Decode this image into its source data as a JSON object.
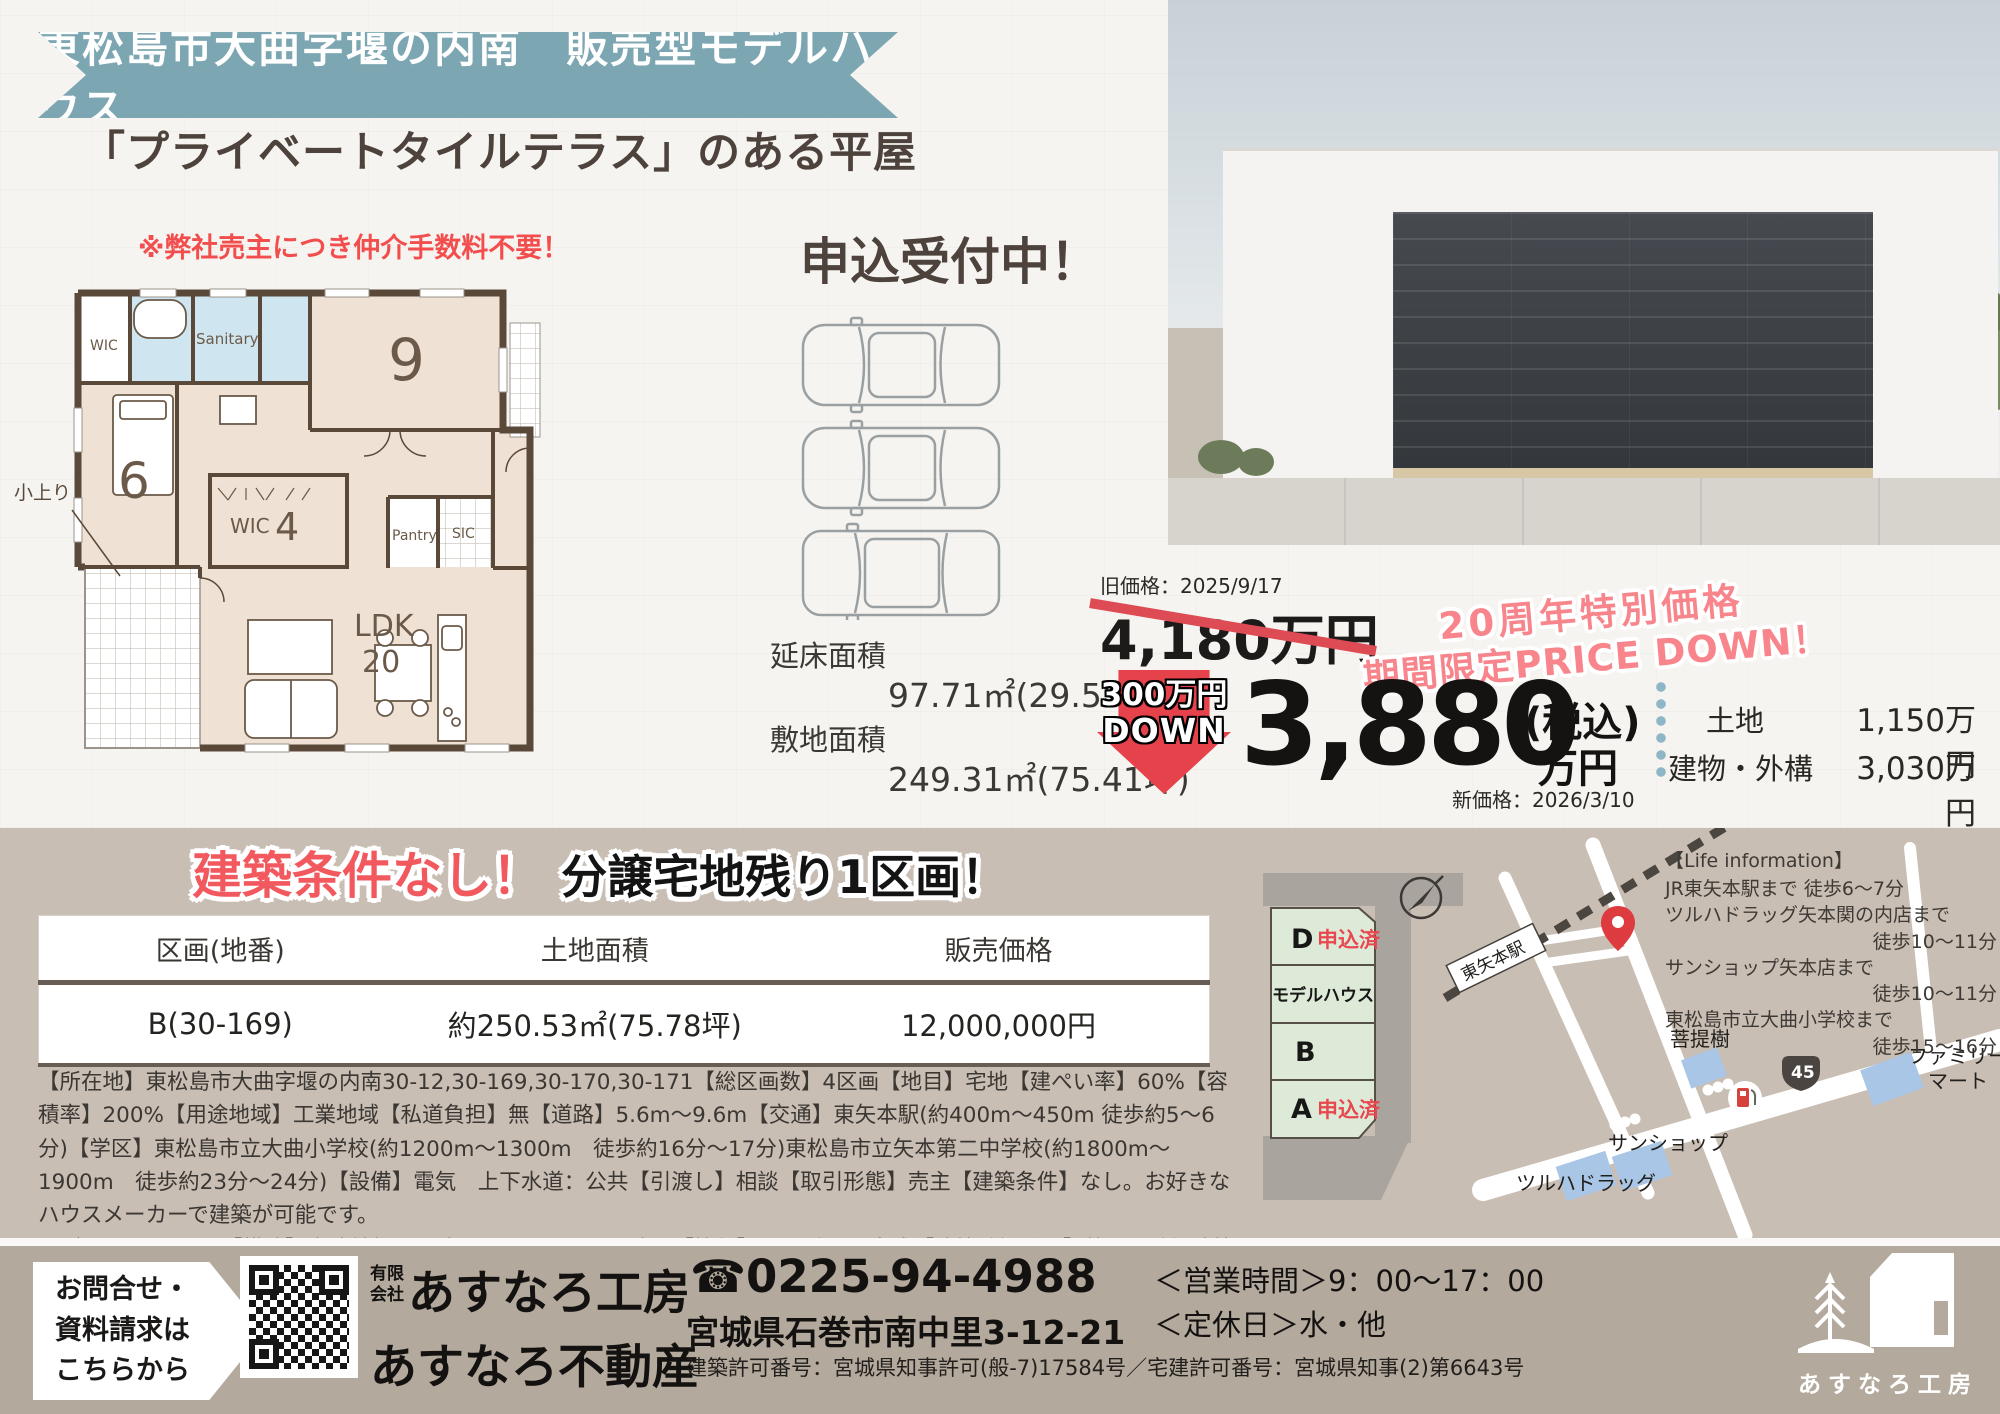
{
  "colors": {
    "banner_teal": "#7ca6b2",
    "accent_red": "#f2595f",
    "dark_brown": "#4e423c",
    "taupe_bg": "#c9beb4",
    "footer_bg": "#b4a99d",
    "lot_green": "#dcead7"
  },
  "header": {
    "banner_title": "東松島市大曲字堰の内南　販売型モデルハウス",
    "catchcopy": "「プライベートタイルテラス」のある平屋",
    "broker_note": "※弊社売主につき仲介手数料不要！",
    "accepting": "申込受付中！"
  },
  "floorplan": {
    "rooms": {
      "wic1": "WIC",
      "sanitary": "Sanitary",
      "bedroom9": "9",
      "bedroom6": "6",
      "koagari": "小上り",
      "wic2": "WIC",
      "wic2_size": "4",
      "pantry": "Pantry",
      "sic": "SIC",
      "ldk": "LDK",
      "ldk_size": "20"
    },
    "floor_area_label": "延床面積",
    "floor_area_value": "97.71㎡(29.55坪)",
    "land_area_label": "敷地面積",
    "land_area_value": "249.31㎡(75.41坪)"
  },
  "price": {
    "old_date": "旧価格：2025/9/17",
    "old_price": "4,180万円",
    "campaign_line1": "20周年特別価格",
    "campaign_line2": "期間限定PRICE DOWN！",
    "down_amount": "300万円",
    "down_word": "DOWN",
    "new_price": "3,880",
    "tax_note": "(税込)",
    "unit": "万円",
    "new_date": "新価格：2026/3/10",
    "breakdown": [
      {
        "label": "土地",
        "value": "1,150万円"
      },
      {
        "label": "建物・外構",
        "value": "3,030万円"
      }
    ]
  },
  "lots": {
    "title_red": "建築条件なし！",
    "title_black": "分譲宅地残り1区画！",
    "table": {
      "headers": [
        "区画(地番)",
        "土地面積",
        "販売価格"
      ],
      "row": [
        "B(30-169)",
        "約250.53㎡(75.78坪)",
        "12,000,000円"
      ]
    },
    "details1": "【所在地】東松島市大曲字堰の内南30-12,30-169,30-170,30-171【総区画数】4区画【地目】宅地【建ぺい率】60%【容積率】200%【用途地域】工業地域【私道負担】無【道路】5.6m〜9.6m【交通】東矢本駅(約400m〜450m 徒歩約5〜6分)【学区】東松島市立大曲小学校(約1200m〜1300m　徒歩約16分〜17分)東松島市立矢本第二中学校(約1800m〜1900m　徒歩約23分〜24分)【設備】電気　上下水道：公共【引渡し】相談【取引形態】売主【建築条件】なし。お好きなハウスメーカーで建築が可能です。",
    "details2": "モデルハウス・・・【構造】木造軸組み工法ガルバリウム平屋建て【築年】2025年9月完成【建築確認番号】第R07確認建築仙台都市7031号",
    "plots": [
      {
        "label": "D",
        "status": "申込済"
      },
      {
        "label": "モデルハウス",
        "status": ""
      },
      {
        "label": "B",
        "status": ""
      },
      {
        "label": "A",
        "status": "申込済"
      }
    ]
  },
  "map": {
    "station": "東矢本駅",
    "route_number": "45",
    "life_title": "【Life information】",
    "life_items": [
      {
        "place": "JR東矢本駅まで 徒歩6〜7分",
        "time": ""
      },
      {
        "place": "ツルハドラッグ矢本関の内店まで",
        "time": "徒歩10〜11分"
      },
      {
        "place": "サンショップ矢本店まで",
        "time": "徒歩10〜11分"
      },
      {
        "place": "東松島市立大曲小学校まで",
        "time": "徒歩15〜16分"
      }
    ],
    "poi_bodaiju": "菩提樹",
    "poi_familymart1": "ファミリー",
    "poi_familymart2": "マート",
    "poi_sunshop": "サンショップ",
    "poi_tsuruha": "ツルハドラッグ"
  },
  "footer": {
    "cta_line1": "お問合せ・",
    "cta_line2": "資料請求は",
    "cta_line3": "こちらから",
    "company_type1": "有限",
    "company_type2": "会社",
    "company_name1": "あすなろ工房",
    "company_name2": "あすなろ不動産",
    "phone": "☎0225-94-4988",
    "address": "宮城県石巻市南中里3-12-21",
    "license": "建築許可番号：宮城県知事許可(般-7)17584号／宅建許可番号：宮城県知事(2)第6643号",
    "hours": "＜営業時間＞9：00〜17：00",
    "holiday": "＜定休日＞水・他",
    "logo_text": "あすなろ工房"
  }
}
